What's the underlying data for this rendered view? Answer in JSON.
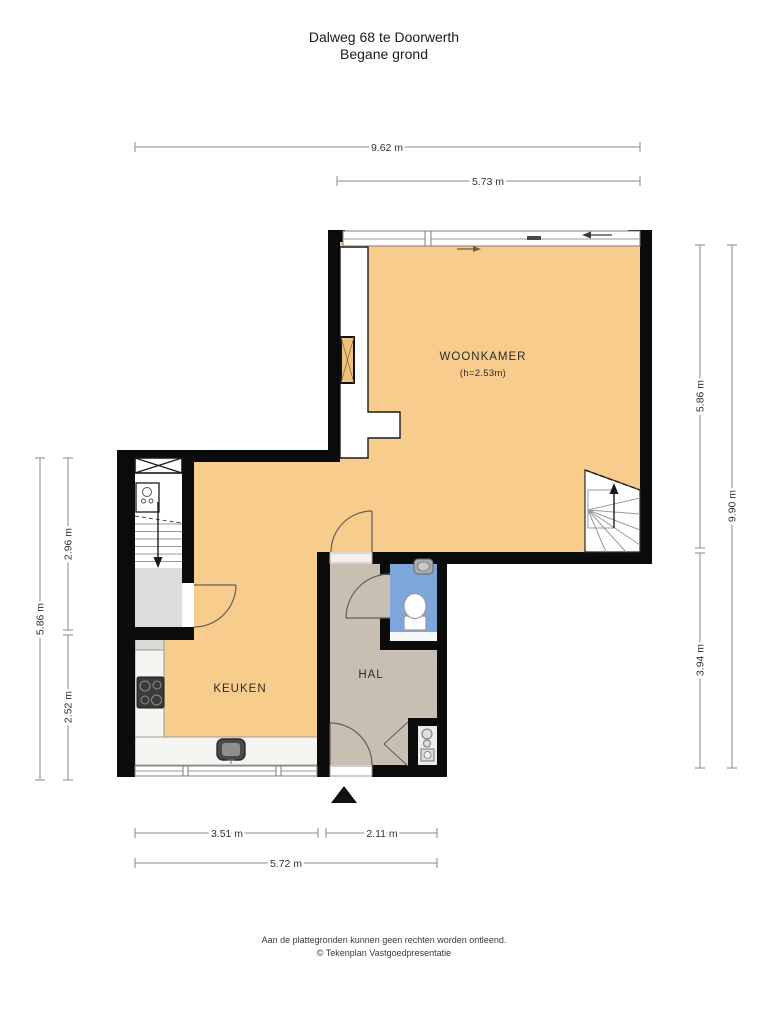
{
  "title": {
    "line1": "Dalweg 68 te Doorwerth",
    "line2": "Begane grond"
  },
  "rooms": {
    "woonkamer": {
      "label": "WOONKAMER",
      "height_note": "(h=2.53m)"
    },
    "keuken": {
      "label": "KEUKEN"
    },
    "hal": {
      "label": "HAL"
    }
  },
  "dimensions": {
    "top": [
      {
        "label": "9.62 m",
        "meters": 9.62
      },
      {
        "label": "5.73 m",
        "meters": 5.73
      }
    ],
    "right": [
      {
        "label": "5.86 m",
        "meters": 5.86
      },
      {
        "label": "3.94 m",
        "meters": 3.94
      },
      {
        "label": "9.90 m",
        "meters": 9.9
      }
    ],
    "left": [
      {
        "label": "5.86 m",
        "meters": 5.86
      },
      {
        "label": "2.96 m",
        "meters": 2.96
      },
      {
        "label": "2.52 m",
        "meters": 2.52
      }
    ],
    "bottom": [
      {
        "label": "3.51 m",
        "meters": 3.51
      },
      {
        "label": "2.11 m",
        "meters": 2.11
      },
      {
        "label": "5.72 m",
        "meters": 5.72
      }
    ]
  },
  "footer": {
    "line1": "Aan de plattegronden kunnen geen rechten worden ontleend.",
    "line2": "© Tekenplan Vastgoedpresentatie"
  },
  "colors": {
    "room_fill": "#F8CC8C",
    "hall_fill": "#C8BFB3",
    "toilet_fill": "#7FA6DB",
    "wall": "#0b0b0b",
    "landing_fill": "#DCDCDC",
    "counter_fill": "#F5F5F1"
  }
}
